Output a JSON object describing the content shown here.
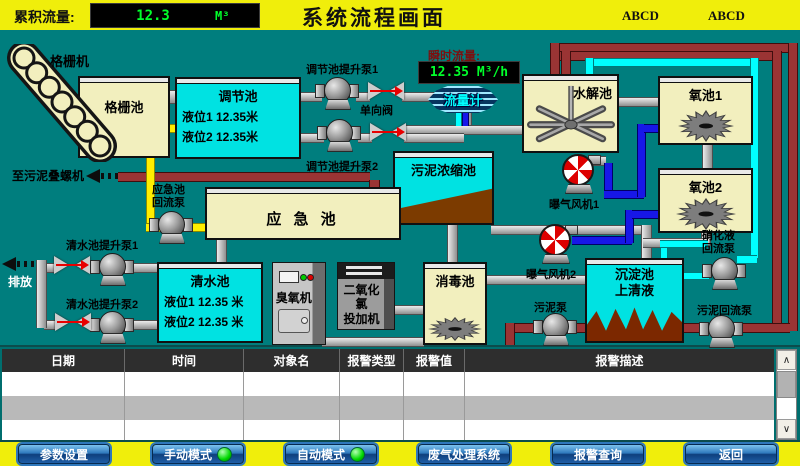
{
  "colors": {
    "background_teal": "#007e7e",
    "bar_yellow": "#f0ee0b",
    "tank_cream": "#f2efbe",
    "tank_cyan": "#00e2e2",
    "display_green": "#00ff2a",
    "pipe_gray": "#c8c8c8",
    "pipe_red": "#9a3434",
    "pipe_yellow": "#ffee00",
    "pipe_blue": "#1717e8",
    "pipe_cyan": "#00ffff",
    "sludge_brown": "#7c3b00",
    "led_green": "#00d800"
  },
  "header": {
    "flow_total_label": "累积流量:",
    "flow_total_value": "12.3",
    "flow_total_unit": "M³",
    "title": "系统流程画面",
    "abcd_left": "ABCD",
    "abcd_right": "ABCD"
  },
  "diagram": {
    "grating_machine_label": "格栅机",
    "grating_pool": "格栅池",
    "regulating_pool": {
      "title": "调节池",
      "level1": "液位1  12.35米",
      "level2": "液位2  12.35米"
    },
    "regulating_pump1": "调节池提升泵1",
    "regulating_pump2": "调节池提升泵2",
    "check_valve": "单向阀",
    "instant_flow_label": "瞬时流量:",
    "instant_flow_value": "12.35 M³/h",
    "flow_meter": "流量计",
    "hydrolysis_pool": "水解池",
    "oxygen_pool1": "氧池1",
    "oxygen_pool2": "氧池2",
    "sludge_thickening_pool": "污泥浓缩池",
    "emergency_pool": "应 急 池",
    "emergency_return_pump": "应急池\n回流泵",
    "to_sludge_screw": "至污泥叠螺机",
    "blower1": "曝气风机1",
    "blower2": "曝气风机2",
    "discharge": "排放",
    "clean_pump1": "清水池提升泵1",
    "clean_pump2": "清水池提升泵2",
    "clean_pool": {
      "title": "清水池",
      "level1": "液位1 12.35 米",
      "level2": "液位2 12.35 米"
    },
    "ozone_machine": "臭氧机",
    "chlorine_doser": "二氧化氯\n投加机",
    "disinfection_pool": "消毒池",
    "sedimentation_pool": "沉淀池\n上清液",
    "sludge_pump": "污泥泵",
    "sludge_return_pump": "污泥回流泵",
    "nitrified_return_pump": "硝化液\n回流泵"
  },
  "alarm_table": {
    "columns": [
      "日期",
      "时间",
      "对象名",
      "报警类型",
      "报警值",
      "报警描述"
    ],
    "rows": [
      [
        "",
        "",
        "",
        "",
        "",
        ""
      ],
      [
        "",
        "",
        "",
        "",
        "",
        ""
      ],
      [
        "",
        "",
        "",
        "",
        "",
        ""
      ]
    ]
  },
  "icons": {
    "scroll_up": "∧",
    "scroll_down": "∨"
  },
  "footer": {
    "buttons": [
      {
        "label": "参数设置",
        "led": false
      },
      {
        "label": "手动模式",
        "led": true
      },
      {
        "label": "自动模式",
        "led": true
      },
      {
        "label": "废气处理系统",
        "led": false
      },
      {
        "label": "报警查询",
        "led": false
      },
      {
        "label": "返回",
        "led": false
      }
    ]
  }
}
